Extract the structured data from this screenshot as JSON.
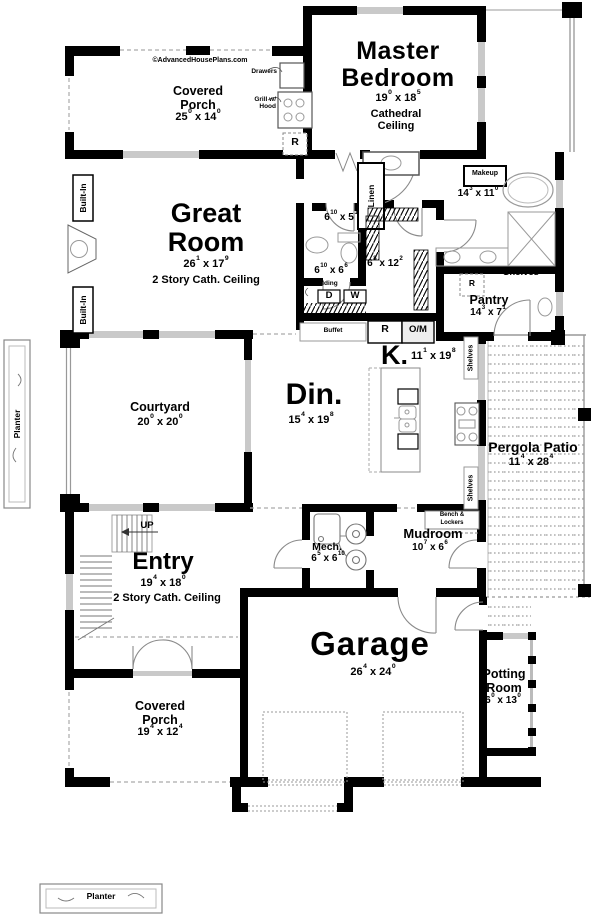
{
  "sep": "x",
  "brand": {
    "symbol": "©",
    "text": "AdvancedHousePlans.com"
  },
  "rooms": {
    "porch_top": {
      "l1": "Covered",
      "l2": "Porch",
      "dim": {
        "w": "25",
        "ws": "0",
        "h": "14",
        "hs": "0"
      }
    },
    "master": {
      "l1": "Master",
      "l2": "Bedroom",
      "dim": {
        "w": "19",
        "ws": "0",
        "h": "18",
        "hs": "5"
      },
      "sub1": "Cathedral",
      "sub2": "Ceiling"
    },
    "great": {
      "l1": "Great",
      "l2": "Room",
      "dim": {
        "w": "26",
        "ws": "1",
        "h": "17",
        "hs": "9"
      },
      "sub": "2 Story Cath. Ceiling"
    },
    "bath": {
      "dim": {
        "w": "14",
        "ws": "3",
        "h": "11",
        "hs": "0"
      }
    },
    "powder": {
      "dim": {
        "w": "6",
        "ws": "10",
        "h": "5",
        "hs": "1"
      }
    },
    "laundry": {
      "dim": {
        "w": "6",
        "ws": "10",
        "h": "6",
        "hs": "6"
      }
    },
    "wic": {
      "dim": {
        "w": "6",
        "ws": "8",
        "h": "12",
        "hs": "2"
      }
    },
    "pantry": {
      "name": "Pantry",
      "dim": {
        "w": "14",
        "ws": "3",
        "h": "7",
        "hs": "1"
      }
    },
    "kitchen": {
      "name": "K.",
      "dim": {
        "w": "11",
        "ws": "1",
        "h": "19",
        "hs": "8"
      }
    },
    "dining": {
      "name": "Din.",
      "dim": {
        "w": "15",
        "ws": "4",
        "h": "19",
        "hs": "8"
      }
    },
    "courtyard": {
      "name": "Courtyard",
      "dim": {
        "w": "20",
        "ws": "0",
        "h": "20",
        "hs": "0"
      }
    },
    "pergola": {
      "name": "Pergola Patio",
      "dim": {
        "w": "11",
        "ws": "4",
        "h": "28",
        "hs": "4"
      }
    },
    "entry": {
      "name": "Entry",
      "dim": {
        "w": "19",
        "ws": "4",
        "h": "18",
        "hs": "0"
      },
      "sub": "2 Story Cath. Ceiling"
    },
    "mech": {
      "name": "Mech.",
      "dim": {
        "w": "6",
        "ws": "5",
        "h": "6",
        "hs": "10"
      }
    },
    "mudroom": {
      "name": "Mudroom",
      "dim": {
        "w": "10",
        "ws": "7",
        "h": "6",
        "hs": "6"
      }
    },
    "garage": {
      "name": "Garage",
      "dim": {
        "w": "26",
        "ws": "4",
        "h": "24",
        "hs": "0"
      }
    },
    "potting": {
      "l1": "Potting",
      "l2": "Room",
      "dim": {
        "w": "6",
        "ws": "0",
        "h": "13",
        "hs": "0"
      }
    },
    "porch_bottom": {
      "l1": "Covered",
      "l2": "Porch",
      "dim": {
        "w": "19",
        "ws": "4",
        "h": "12",
        "hs": "4"
      }
    }
  },
  "labels": {
    "drawers": "Drawers",
    "grill1": "Grill w/",
    "grill2": "Hood",
    "r": "R",
    "om": "O/M",
    "linen": "Linen",
    "makeup": "Makeup",
    "shelves": "Shelves",
    "folding": "Folding",
    "d": "D",
    "w": "W",
    "buffet": "Buffet",
    "up": "UP",
    "bench1": "Bench &",
    "bench2": "Lockers",
    "built_in": "Built-In",
    "planter": "Planter"
  },
  "colors": {
    "wall": "#000000",
    "window": "#c9c9c9",
    "fixture": "#999999",
    "dash": "#aaaaaa"
  }
}
